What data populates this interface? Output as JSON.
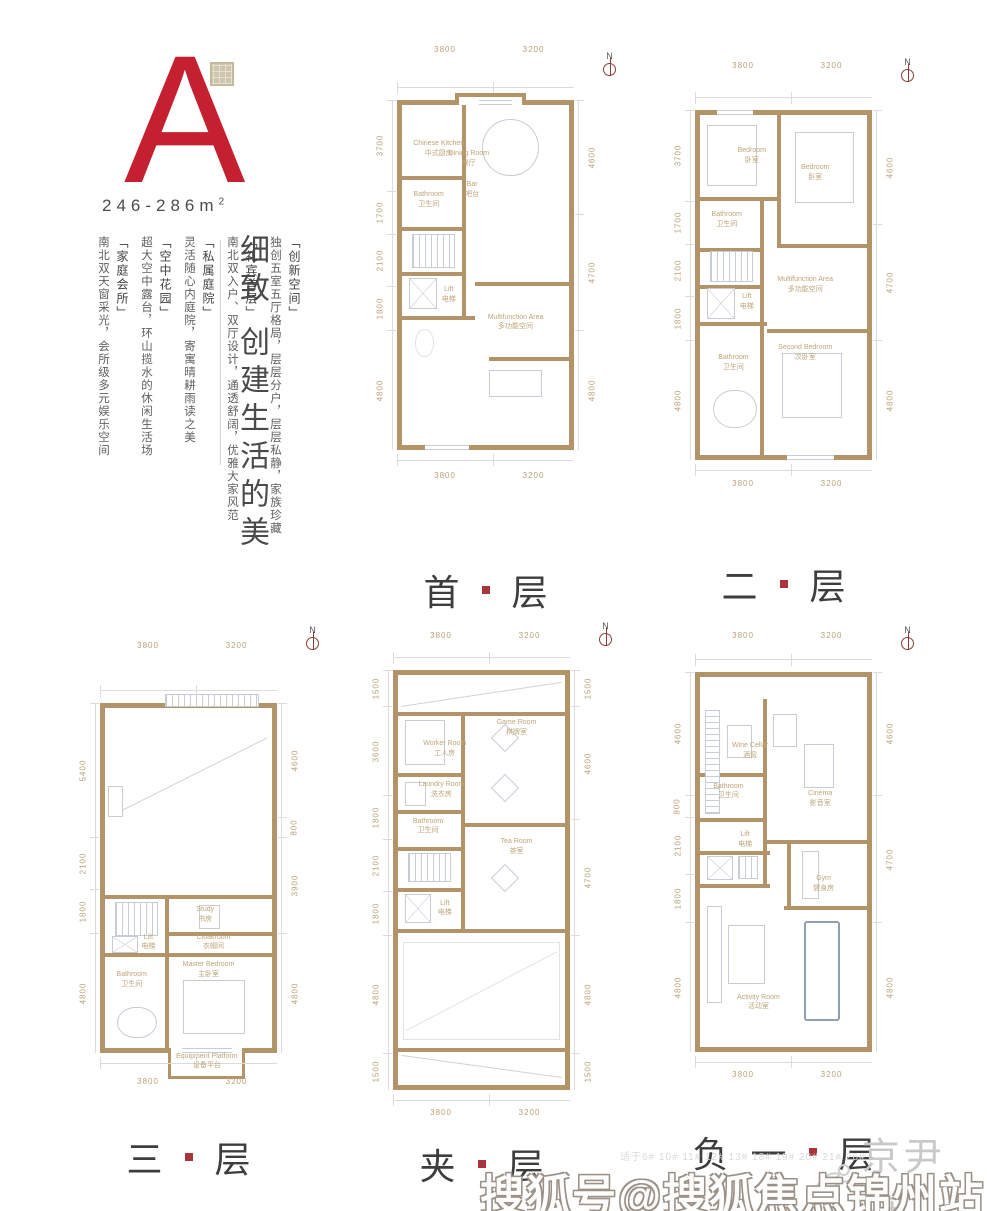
{
  "colors": {
    "accent_red": "#c5202f",
    "wall_tan": "#b29468",
    "dim_text": "#bba176",
    "room_text": "#bfa578",
    "floor_label": "#3d3d3d",
    "seal_red": "#a8343c"
  },
  "unit": {
    "letter": "A",
    "area": "246-286m",
    "area_sup": "2"
  },
  "tagline": {
    "headline": "细致 创建生活的美"
  },
  "features": [
    {
      "tag": "「创新空间」",
      "text": "独创五室五厅格局，层层分户，层层私静，家族珍藏"
    },
    {
      "tag": "「礼宾首层」",
      "text": "南北双入户、双厅设计，通透舒阔，优雅大家风范"
    },
    {
      "tag": "「私属庭院」",
      "text": "灵活随心内庭院，寄寓晴耕雨读之美"
    },
    {
      "tag": "「空中花园」",
      "text": "超大空中露台，环山揽水的休闲生活场"
    },
    {
      "tag": "「家庭会所」",
      "text": "南北双天窗采光，会所级多元娱乐空间"
    }
  ],
  "north_label": "N",
  "floors": [
    {
      "name_a": "首",
      "name_b": "层",
      "top_dims": [
        "3800",
        "3200"
      ],
      "bottom_dims": [
        "3800",
        "3200"
      ],
      "left_dims": [
        "3700",
        "1700",
        "2100",
        "1800",
        "4800"
      ],
      "right_dims": [
        "4600",
        "4700",
        "4800"
      ],
      "rooms": [
        {
          "en": "Chinese Kitchen",
          "zh": "中式厨房"
        },
        {
          "en": "Dining Room",
          "zh": "餐厅"
        },
        {
          "en": "Bar",
          "zh": "吧台"
        },
        {
          "en": "Bathroom",
          "zh": "卫生间"
        },
        {
          "en": "Lift",
          "zh": "电梯"
        },
        {
          "en": "Multifunction Area",
          "zh": "多功能空间"
        }
      ]
    },
    {
      "name_a": "二",
      "name_b": "层",
      "top_dims": [
        "3800",
        "3200"
      ],
      "bottom_dims": [
        "3800",
        "3200"
      ],
      "left_dims": [
        "3700",
        "1700",
        "2100",
        "1800",
        "4800"
      ],
      "right_dims": [
        "4600",
        "4700",
        "4800"
      ],
      "rooms": [
        {
          "en": "Bedroom",
          "zh": "卧室"
        },
        {
          "en": "Bedroom",
          "zh": "卧室"
        },
        {
          "en": "Bathroom",
          "zh": "卫生间"
        },
        {
          "en": "Multifunction Area",
          "zh": "多功能空间"
        },
        {
          "en": "Lift",
          "zh": "电梯"
        },
        {
          "en": "Second Bedroom",
          "zh": "次卧室"
        },
        {
          "en": "Bathroom",
          "zh": "卫生间"
        }
      ]
    },
    {
      "name_a": "三",
      "name_b": "层",
      "top_dims": [
        "3800",
        "3200"
      ],
      "bottom_dims": [
        "3800",
        "3200"
      ],
      "left_dims": [
        "5400",
        "2100",
        "1800",
        "4800"
      ],
      "right_dims": [
        "4600",
        "800",
        "3900",
        "4800"
      ],
      "rooms": [
        {
          "en": "Study",
          "zh": "书房"
        },
        {
          "en": "Lift",
          "zh": "电梯"
        },
        {
          "en": "Cloakroom",
          "zh": "衣帽间"
        },
        {
          "en": "Bathroom",
          "zh": "卫生间"
        },
        {
          "en": "Master Bedroom",
          "zh": "主卧室"
        },
        {
          "en": "Equipment Platform",
          "zh": "设备平台"
        }
      ]
    },
    {
      "name_a": "夹",
      "name_b": "层",
      "top_dims": [
        "3800",
        "3200"
      ],
      "bottom_dims": [
        "3800",
        "3200"
      ],
      "left_dims": [
        "1500",
        "3600",
        "1800",
        "2100",
        "1800",
        "4800",
        "1500"
      ],
      "right_dims": [
        "1500",
        "4600",
        "4700",
        "4800",
        "1500"
      ],
      "rooms": [
        {
          "en": "Worker Room",
          "zh": "工人房"
        },
        {
          "en": "Game Room",
          "zh": "棋牌室"
        },
        {
          "en": "Laundry Room",
          "zh": "洗衣房"
        },
        {
          "en": "Bathroom",
          "zh": "卫生间"
        },
        {
          "en": "Tea Room",
          "zh": "茶室"
        },
        {
          "en": "Lift",
          "zh": "电梯"
        }
      ]
    },
    {
      "name_a": "负一",
      "name_b": "层",
      "top_dims": [
        "3800",
        "3200"
      ],
      "bottom_dims": [
        "3800",
        "3200"
      ],
      "left_dims": [
        "4600",
        "800",
        "2100",
        "1800",
        "4800"
      ],
      "right_dims": [
        "4600",
        "4700",
        "4800"
      ],
      "rooms": [
        {
          "en": "Wine Cellar",
          "zh": "酒窖"
        },
        {
          "en": "Cinema",
          "zh": "影音室"
        },
        {
          "en": "Bathroom",
          "zh": "卫生间"
        },
        {
          "en": "Lift",
          "zh": "电梯"
        },
        {
          "en": "Gym",
          "zh": "健身房"
        },
        {
          "en": "Activity Room",
          "zh": "活动室"
        }
      ]
    }
  ],
  "footer": {
    "applicability": "适于6# 10# 11# 12# 13# 18# 19# 20# 21# 26#",
    "logo": "京尹府",
    "watermark": "搜狐号@搜狐焦点锦州站"
  }
}
